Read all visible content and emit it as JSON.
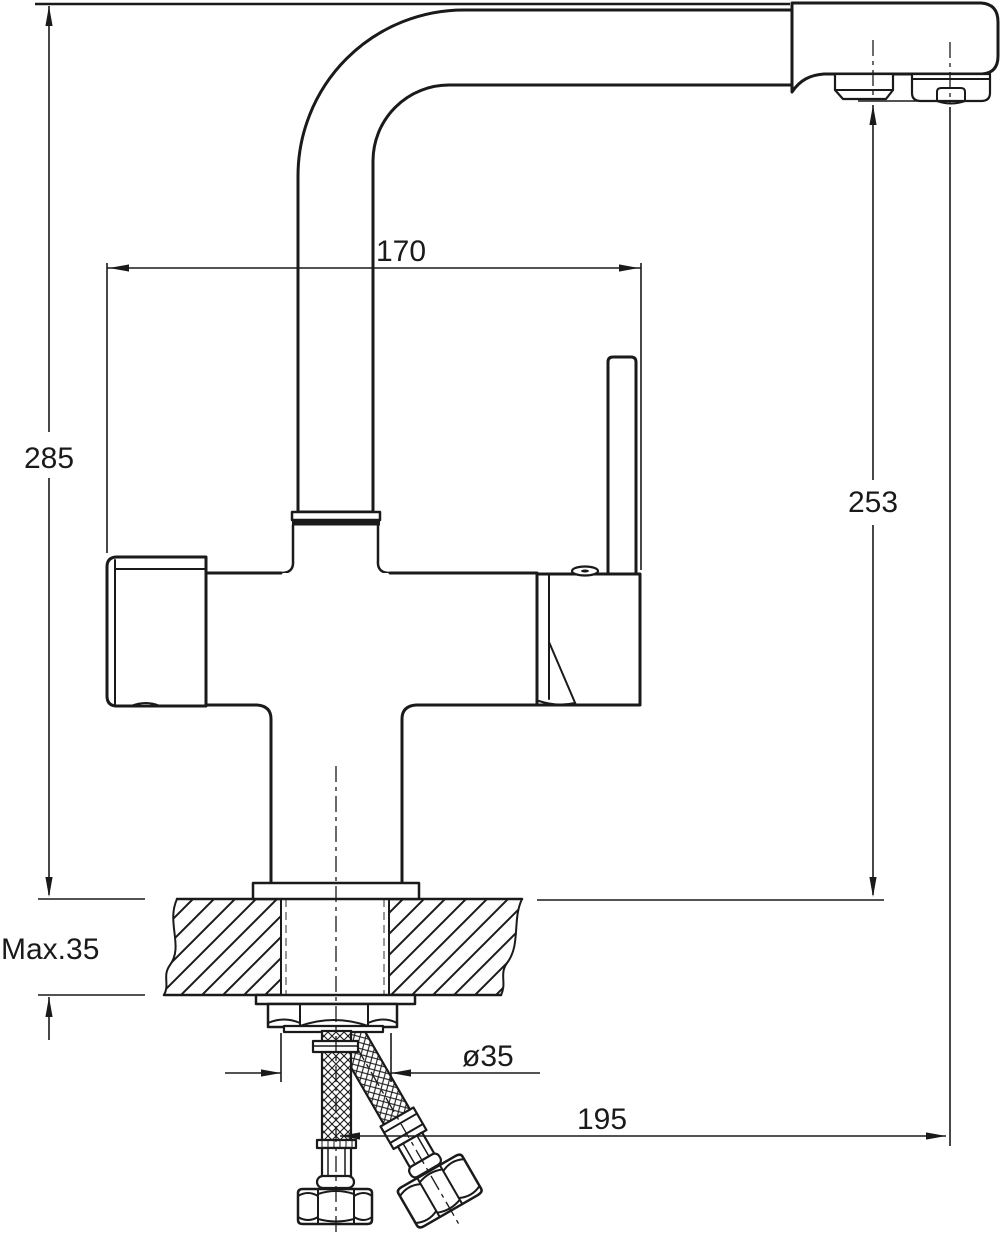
{
  "drawing": {
    "title": "kitchen mixer tap installation drawing",
    "background_color": "#ffffff",
    "line_color": "#1a1a1a",
    "dimensions": {
      "width_across_handles": "170",
      "overall_height": "285",
      "outlet_height": "253",
      "max_counter_thickness": "Max.35",
      "hole_diameter": "ø35",
      "reach_to_outlet": "195"
    }
  }
}
